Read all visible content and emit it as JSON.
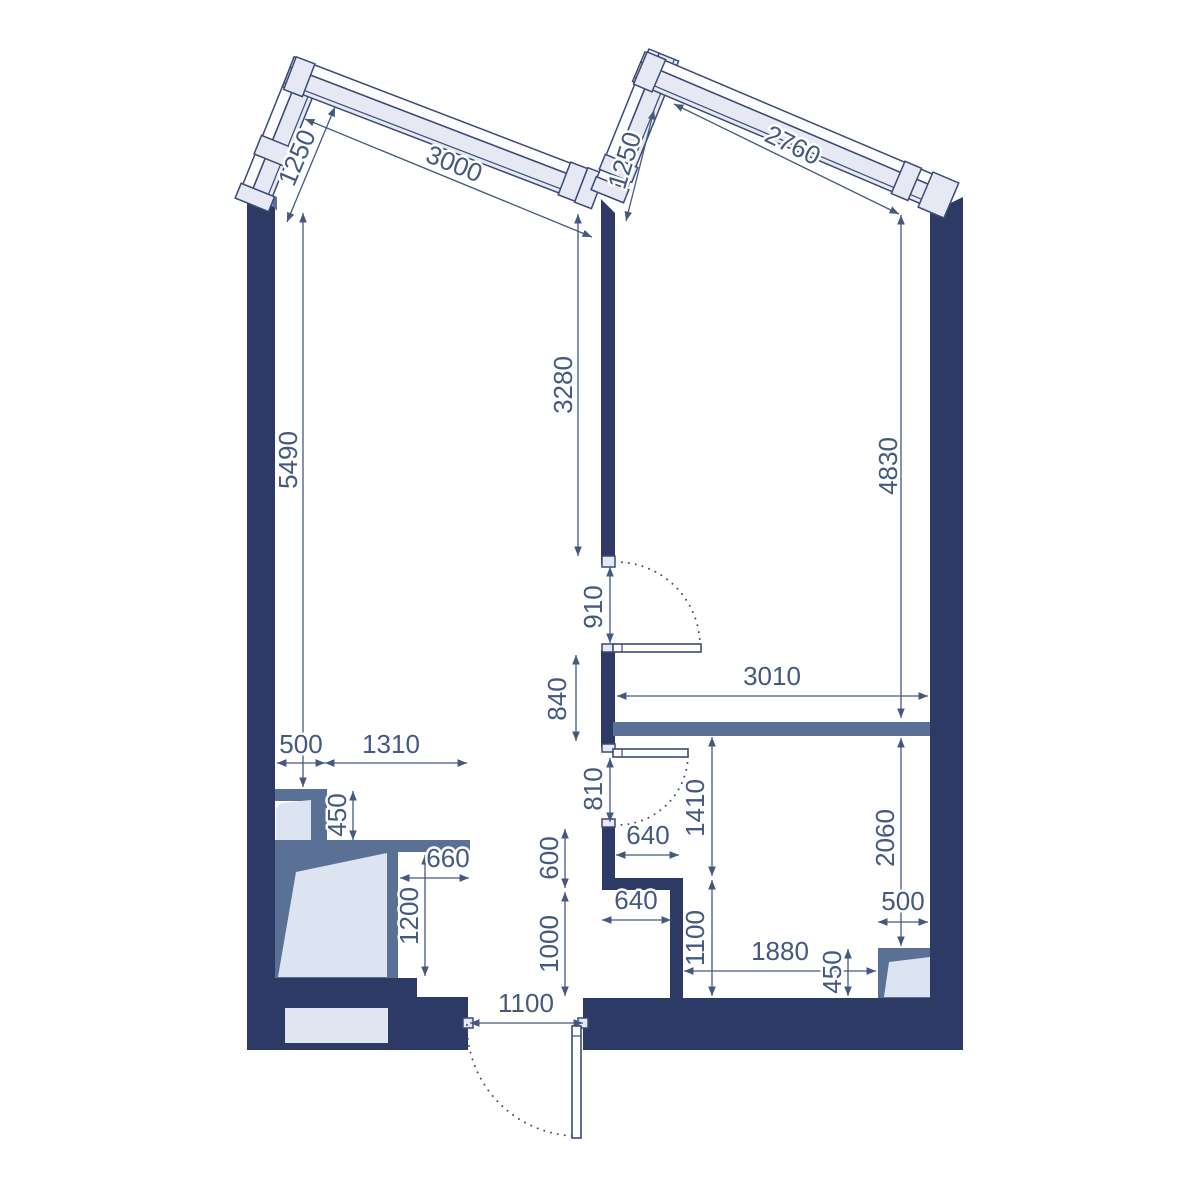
{
  "drawing": {
    "kind": "apartment floor plan",
    "units": "mm"
  },
  "colors": {
    "wall_dark": "#2e3a66",
    "wall_medium": "#5a7195",
    "window_fill": "#e6e9f3",
    "shaft_fill": "#dde4f1",
    "dimension": "#44597f",
    "background": "#ffffff"
  },
  "dims": {
    "win_left_short": "1250",
    "win_left_long": "3000",
    "win_right_short": "1250",
    "win_right_long": "2760",
    "left_room_height": "5490",
    "mid_wall": "3280",
    "right_room_height": "4830",
    "door_living": "910",
    "wall_between_doors": "840",
    "bedroom_width": "3010",
    "door_bedroom": "810",
    "hall_upper": "1410",
    "right_lower": "2060",
    "shaft_offset": "500",
    "shaft_width": "1310",
    "shaft_small_depth": "450",
    "shaft_right_gap": "660",
    "shaft_large_height": "1200",
    "bath_upper": "600",
    "bath_width_top": "640",
    "bath_width_bottom": "640",
    "bath_lower": "1000",
    "hall_lower": "1100",
    "bottom_room_width": "1880",
    "corner_shaft_height": "450",
    "corner_shaft_width": "500",
    "entrance_door": "1100"
  }
}
